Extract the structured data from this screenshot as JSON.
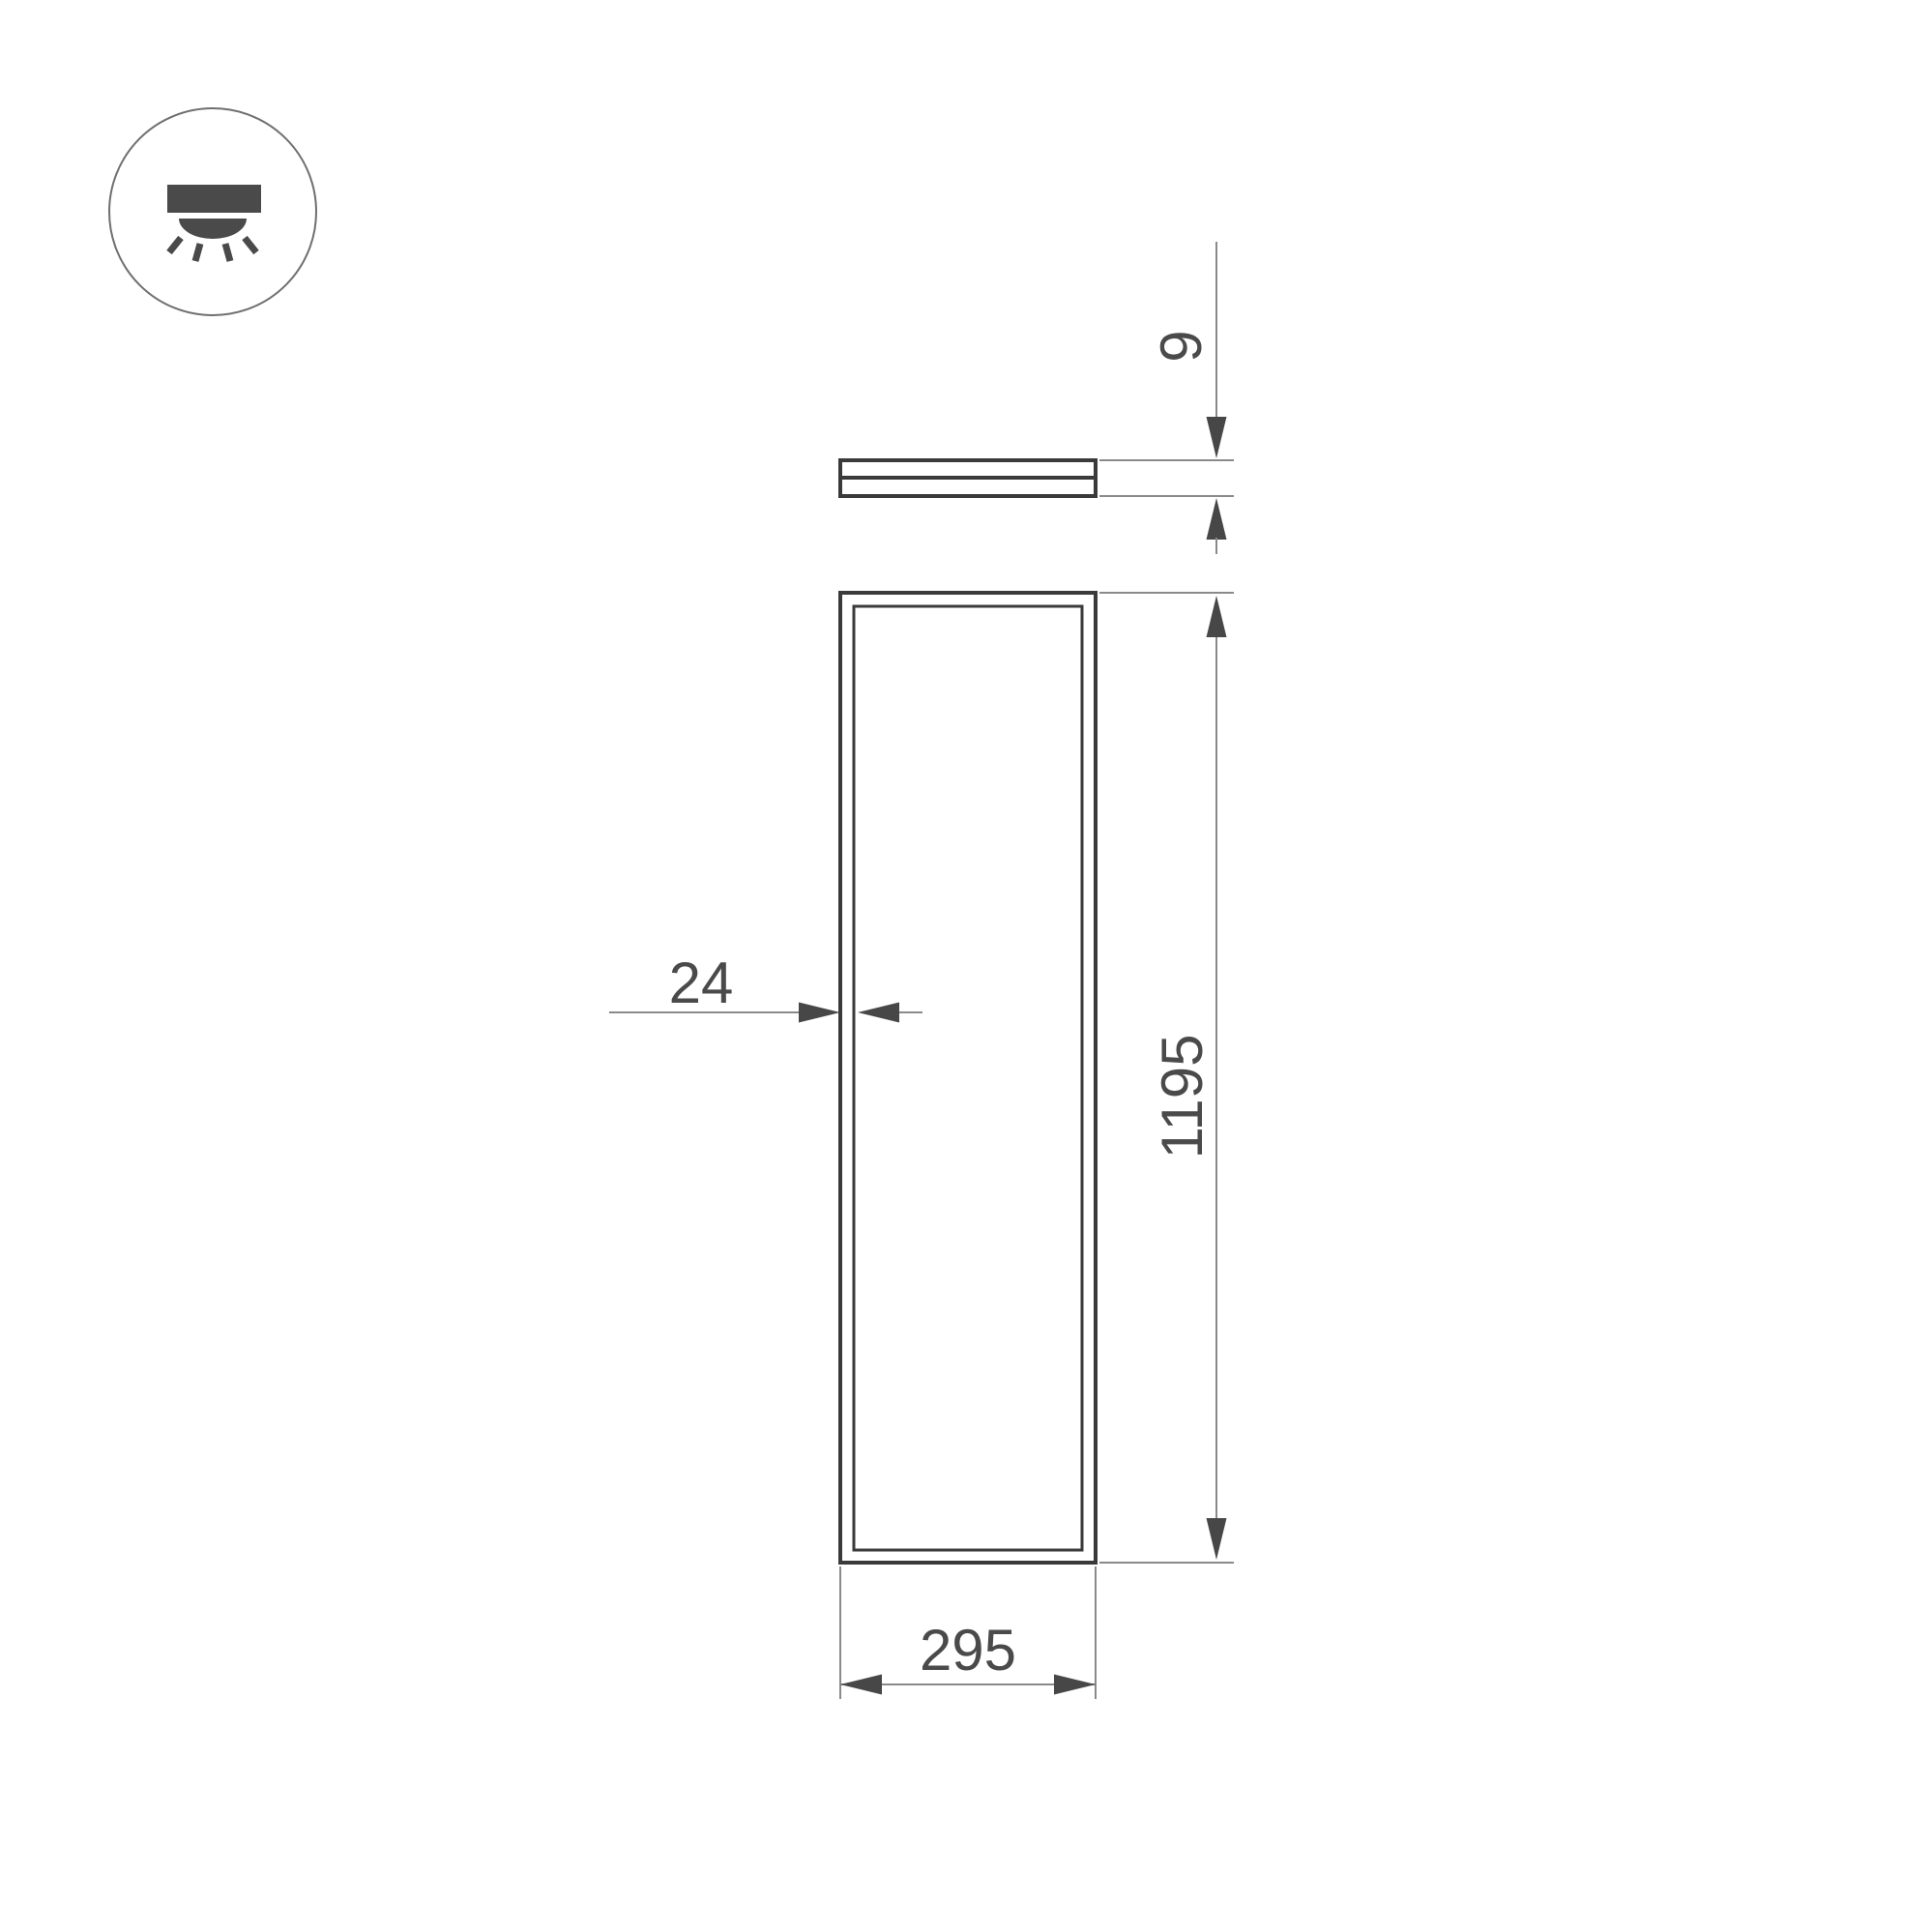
{
  "drawing": {
    "type": "technical-dimension-drawing",
    "subject": "led-panel-light",
    "dimensions": {
      "thickness": "9",
      "length": "1195",
      "frame_width": "24",
      "width": "295"
    },
    "icon": "recessed-downlight-icon",
    "colors": {
      "outline": "#3a3a3a",
      "dimension_line": "#8a8a8a",
      "text": "#4a4a4a",
      "background": "#ffffff"
    }
  }
}
